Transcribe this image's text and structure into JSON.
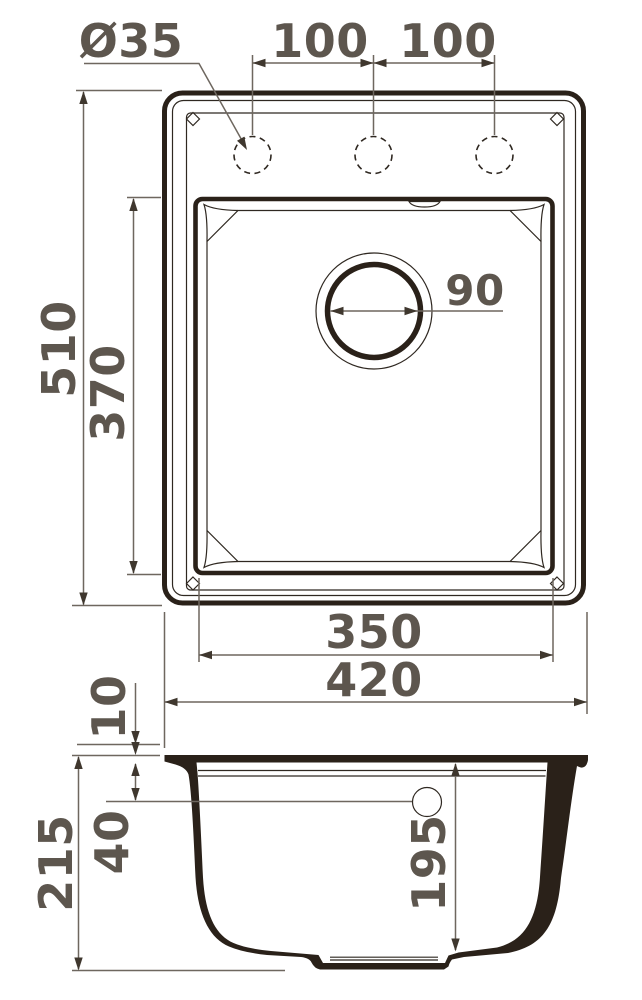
{
  "colors": {
    "outline": "#2a2119",
    "dim_line": "#6e675f",
    "dim_text": "#5d564e"
  },
  "top_view": {
    "faucet_hole_diameter": "Ø35",
    "faucet_hole_spacing_left": "100",
    "faucet_hole_spacing_right": "100",
    "overall_length": "510",
    "bowl_length": "370",
    "drain_diameter": "90",
    "bowl_width": "350",
    "overall_width": "420"
  },
  "side_view": {
    "rim_thickness": "10",
    "overall_height": "215",
    "overflow_drop": "40",
    "bowl_depth": "195"
  }
}
